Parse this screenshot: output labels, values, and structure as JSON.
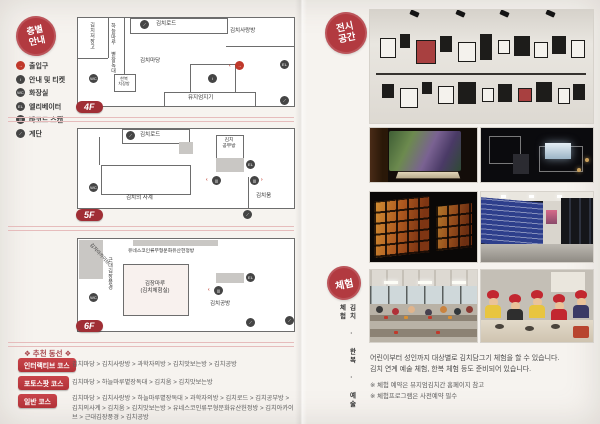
{
  "icons": {
    "entrance": "→",
    "info": "i",
    "restroom": "WC",
    "elevator": "EL",
    "barcode": "|||",
    "stairs": "⟋",
    "arrow_left": "‹",
    "arrow_right": "›"
  },
  "left": {
    "badge": {
      "line1": "층별",
      "line2": "안내"
    },
    "legend": [
      {
        "label": "출입구"
      },
      {
        "label": "안내 및 티켓"
      },
      {
        "label": "화장실"
      },
      {
        "label": "엘리베이터"
      },
      {
        "label": "바코드 스캔"
      },
      {
        "label": "계단"
      }
    ],
    "floors": {
      "f4": {
        "tag": "4F",
        "storage": "김치저장고",
        "jangdokdae": "하늘마루 볕장독대",
        "road": "김치로드",
        "sarangbang": "김치사랑방",
        "madang": "김치마당",
        "hanbok_line1": "한복",
        "hanbok_line2": "치장방",
        "keeper": "뮤지엄지기"
      },
      "f5": {
        "tag": "5F",
        "road": "김치로드",
        "study_line1": "김치",
        "study_line2": "공부방",
        "seasons": "김치의 사계",
        "um": "김치움"
      },
      "f6": {
        "tag": "6F",
        "archive": "김치아카이브",
        "unesco": "유네스코인류무형문화유산헌정방",
        "modern": "근대김장풍경",
        "maru_line1": "김장마루",
        "maru_line2": "(김치체험실)",
        "gongbang": "김치공방"
      }
    },
    "courses": {
      "heading": "❖ 추천 동선 ❖",
      "items": [
        {
          "label": "인터랙티브 코스",
          "route": "김치마당 > 김치사랑방 > 과학자의방 > 김치맛보는방 > 김치공방"
        },
        {
          "label": "포토스팟 코스",
          "route": "김치마당 > 하늘마루볕장독대 > 김치움 > 김치맛보는방"
        },
        {
          "label": "일반 코스",
          "route": "김치마당 > 김치사랑방 > 하늘마루볕장독대 > 과학자의방 > 김치로드 > 김치공부방 > 김치의사계 > 김치움 > 김치맛보는방 > 유네스코인류무형문화유산헌정방 > 김치아카이브 > 근대김장풍경 > 김치공방"
        }
      ]
    }
  },
  "right": {
    "exhibit_badge": {
      "line1": "전시",
      "line2": "공간"
    },
    "experience_badge": "체험",
    "experience_side": "김치 · 한복 · 예술 체험",
    "paragraph": [
      "어린이부터 성인까지 대상별로 김치담그기 체험을 할 수 있습니다.",
      "김치 연계 예술 체험, 한복 체험 등도 준비되어 있습니다."
    ],
    "notes": [
      "※ 체험 예약은 뮤지엄김치간 홈페이지 참고",
      "※ 체험프로그램은 사전예약 필수"
    ]
  }
}
